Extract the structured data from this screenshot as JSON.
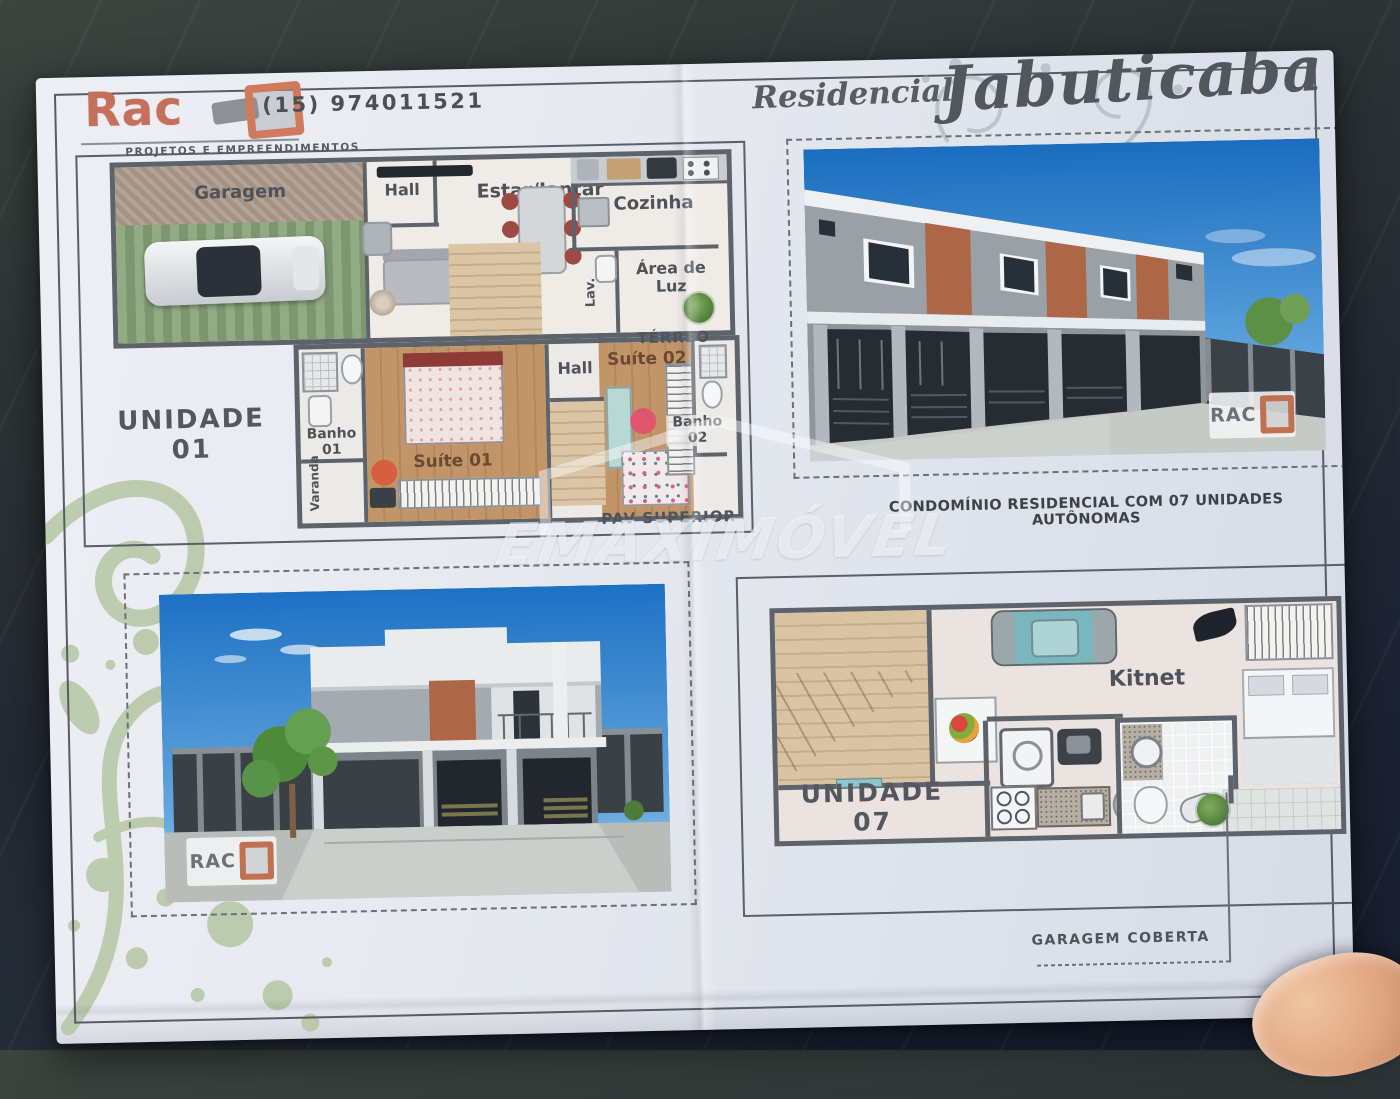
{
  "header": {
    "brand": "Rac",
    "tagline": "PROJETOS E EMPREENDIMENTOS",
    "phone": "(15) 974011521",
    "title_prefix": "Residencial",
    "title": "Jabuticaba"
  },
  "caption": "CONDOMÍNIO RESIDENCIAL COM 07 UNIDADES AUTÔNOMAS",
  "watermark": "EMAXIMÓVEL",
  "brand_mark": "RAC",
  "unit01": {
    "label": "UNIDADE 01",
    "terreo_label": "TÉRREO",
    "superior_label": "PAV SUPERIOR",
    "rooms": {
      "garagem": "Garagem",
      "hall": "Hall",
      "estar": "Estar/Jantar",
      "cozinha": "Cozinha",
      "lav": "Lav.",
      "area_luz": "Área de Luz",
      "banho01": "Banho 01",
      "suite01": "Suíte 01",
      "hall2": "Hall",
      "suite02": "Suíte 02",
      "banho02": "Banho 02",
      "varanda": "Varanda"
    }
  },
  "unit07": {
    "label": "UNIDADE 07",
    "kitnet": "Kitnet",
    "note": "GARAGEM COBERTA"
  },
  "colors": {
    "brand_orange": "#cf7a5c",
    "plan_wall": "#5c636a",
    "wood_floor": "#c29569",
    "sky_blue": "#1a6dbf",
    "accent_brick": "#ad6746",
    "paper": "#e6e9f0",
    "flourish_green": "#b4c6a2"
  }
}
